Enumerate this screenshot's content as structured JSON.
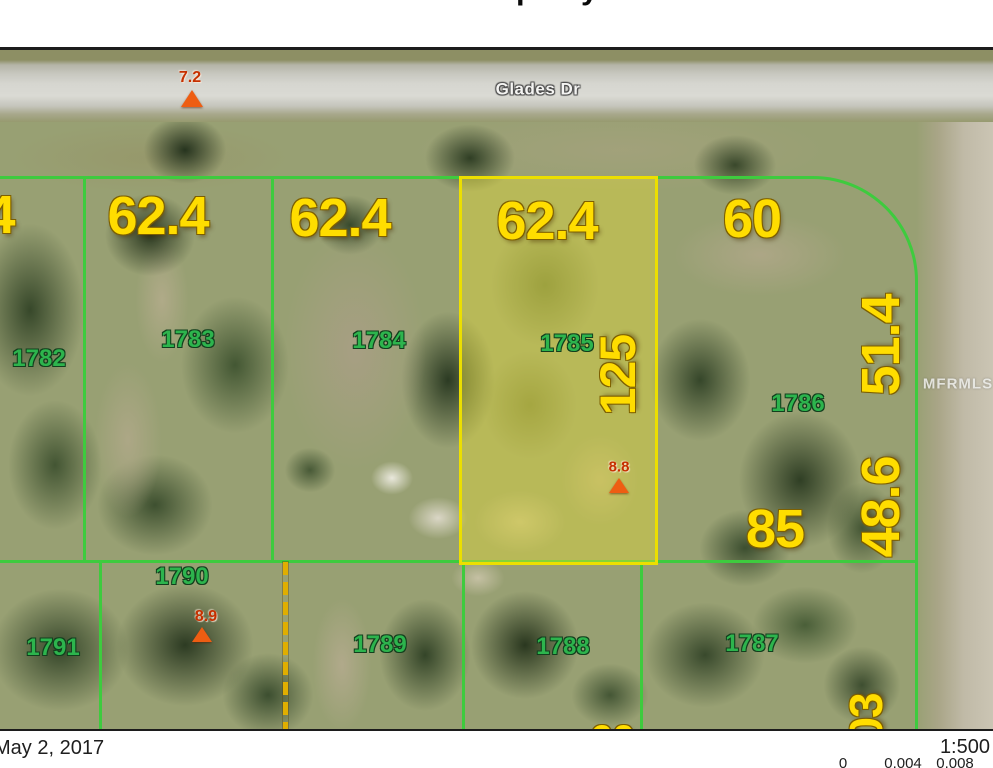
{
  "header": {
    "clipped_title_fragments": [
      "p",
      "y"
    ]
  },
  "map": {
    "street_label": "Glades Dr",
    "watermark": "MFRMLS",
    "parcels": [
      {
        "id": "1782"
      },
      {
        "id": "1783"
      },
      {
        "id": "1784"
      },
      {
        "id": "1785",
        "highlighted": true
      },
      {
        "id": "1786"
      },
      {
        "id": "1787"
      },
      {
        "id": "1788"
      },
      {
        "id": "1789"
      },
      {
        "id": "1790"
      },
      {
        "id": "1791"
      }
    ],
    "dimensions": [
      {
        "value": "4",
        "note": "partial, clipped at left edge"
      },
      {
        "value": "62.4"
      },
      {
        "value": "62.4"
      },
      {
        "value": "62.4"
      },
      {
        "value": "60"
      },
      {
        "value": "125",
        "rotated": true
      },
      {
        "value": "51.4",
        "rotated": true
      },
      {
        "value": "48.6",
        "rotated": true
      },
      {
        "value": "85"
      },
      {
        "value": "03",
        "rotated": true,
        "note": "partial, clipped at bottom edge"
      },
      {
        "value": "60",
        "note": "partial, clipped at bottom map edge"
      }
    ],
    "elevation_markers": [
      {
        "value": "7.2"
      },
      {
        "value": "8.8"
      },
      {
        "value": "8.9"
      }
    ],
    "colors": {
      "dimension_text": "#ffdd00",
      "parcel_text": "#2db44d",
      "boundary_line": "#3ecb3e",
      "highlight_border": "#ecdf00",
      "highlight_fill": "rgba(228,220,52,0.42)",
      "marker_text": "#c63000",
      "marker_triangle": "#ee5d12",
      "dashed_line": "#e0ae00"
    }
  },
  "footer": {
    "date": "May 2, 2017",
    "scale": "1:500",
    "scale_ticks": [
      "0",
      "0.004",
      "0.008"
    ]
  }
}
